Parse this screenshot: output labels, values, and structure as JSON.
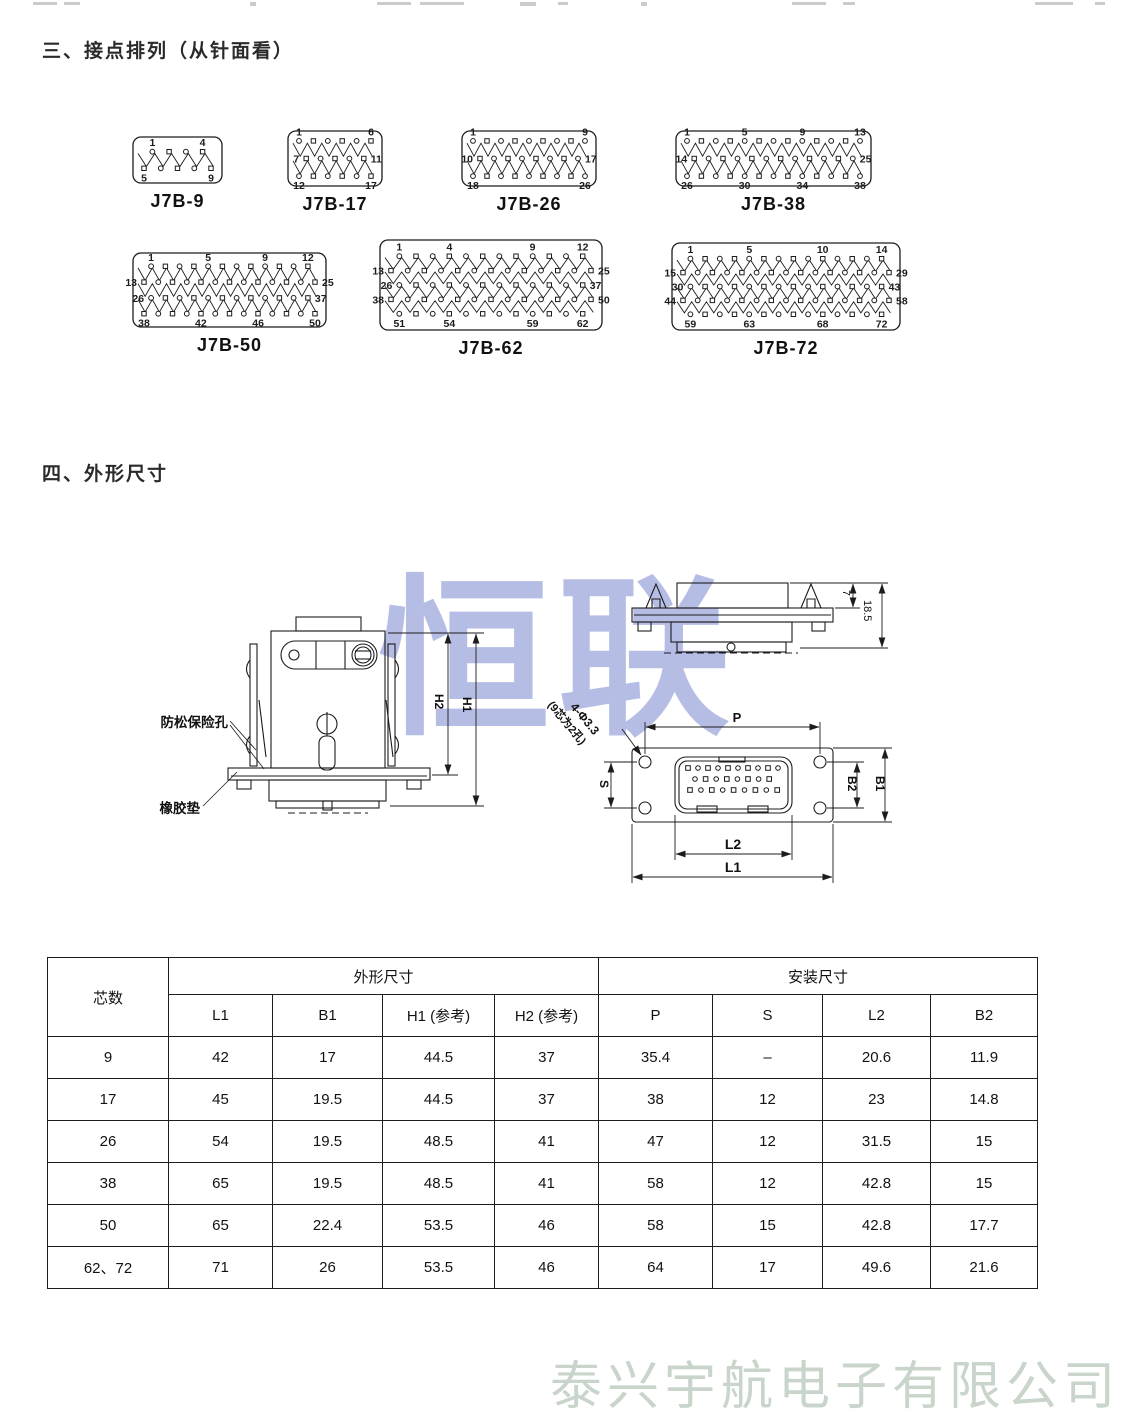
{
  "page": {
    "section3_title": "三、接点排列（从针面看）",
    "section4_title": "四、外形尺寸",
    "center_watermark": "恒联",
    "footer_watermark": "泰兴宇航电子有限公司"
  },
  "connectors": [
    {
      "name": "J7B-9",
      "x": 133,
      "y": 137,
      "w": 89,
      "h": 46,
      "rows": [
        {
          "n": 4,
          "pos": "above",
          "labels": [
            [
              "1",
              0
            ],
            [
              "4",
              1
            ]
          ]
        },
        {
          "n": 5,
          "pos": "below",
          "labels": [
            [
              "5",
              0
            ],
            [
              "9",
              1
            ]
          ]
        }
      ]
    },
    {
      "name": "J7B-17",
      "x": 288,
      "y": 131,
      "w": 94,
      "h": 55,
      "rows": [
        {
          "n": 6,
          "pos": "above",
          "labels": [
            [
              "1",
              0
            ],
            [
              "6",
              1
            ]
          ]
        },
        {
          "n": 5,
          "pos": "side",
          "labels": [
            [
              "7",
              0
            ],
            [
              "11",
              1
            ]
          ]
        },
        {
          "n": 6,
          "pos": "below",
          "labels": [
            [
              "12",
              0
            ],
            [
              "17",
              1
            ]
          ]
        }
      ]
    },
    {
      "name": "J7B-26",
      "x": 462,
      "y": 131,
      "w": 134,
      "h": 55,
      "rows": [
        {
          "n": 9,
          "pos": "above",
          "labels": [
            [
              "1",
              0
            ],
            [
              "9",
              1
            ]
          ]
        },
        {
          "n": 8,
          "pos": "side",
          "labels": [
            [
              "10",
              0
            ],
            [
              "17",
              1
            ]
          ]
        },
        {
          "n": 9,
          "pos": "below",
          "labels": [
            [
              "18",
              0
            ],
            [
              "26",
              1
            ]
          ]
        }
      ]
    },
    {
      "name": "J7B-38",
      "x": 676,
      "y": 131,
      "w": 195,
      "h": 55,
      "rows": [
        {
          "n": 13,
          "pos": "above",
          "labels": [
            [
              "1",
              0
            ],
            [
              "5",
              0.333
            ],
            [
              "9",
              0.667
            ],
            [
              "13",
              1
            ]
          ]
        },
        {
          "n": 12,
          "pos": "side",
          "labels": [
            [
              "14",
              0
            ],
            [
              "25",
              1
            ]
          ]
        },
        {
          "n": 13,
          "pos": "below",
          "labels": [
            [
              "26",
              0
            ],
            [
              "30",
              0.333
            ],
            [
              "34",
              0.667
            ],
            [
              "38",
              1
            ]
          ]
        }
      ]
    },
    {
      "name": "J7B-50",
      "x": 133,
      "y": 253,
      "w": 193,
      "h": 74,
      "rows": [
        {
          "n": 12,
          "pos": "above",
          "labels": [
            [
              "1",
              0
            ],
            [
              "5",
              0.364
            ],
            [
              "9",
              0.727
            ],
            [
              "12",
              1
            ]
          ]
        },
        {
          "n": 13,
          "pos": "side",
          "labels": [
            [
              "13",
              0
            ],
            [
              "25",
              1
            ]
          ]
        },
        {
          "n": 12,
          "pos": "side",
          "labels": [
            [
              "26",
              0
            ],
            [
              "37",
              1
            ]
          ]
        },
        {
          "n": 13,
          "pos": "below",
          "labels": [
            [
              "38",
              0
            ],
            [
              "42",
              0.333
            ],
            [
              "46",
              0.667
            ],
            [
              "50",
              1
            ]
          ]
        }
      ]
    },
    {
      "name": "J7B-62",
      "x": 380,
      "y": 240,
      "w": 222,
      "h": 90,
      "rows": [
        {
          "n": 12,
          "pos": "above",
          "labels": [
            [
              "1",
              0
            ],
            [
              "4",
              0.273
            ],
            [
              "9",
              0.727
            ],
            [
              "12",
              1
            ]
          ]
        },
        {
          "n": 13,
          "pos": "side",
          "labels": [
            [
              "13",
              0
            ],
            [
              "25",
              1
            ]
          ]
        },
        {
          "n": 12,
          "pos": "side",
          "labels": [
            [
              "26",
              0
            ],
            [
              "37",
              1
            ]
          ]
        },
        {
          "n": 13,
          "pos": "side",
          "labels": [
            [
              "38",
              0
            ],
            [
              "50",
              1
            ]
          ]
        },
        {
          "n": 12,
          "pos": "below",
          "labels": [
            [
              "51",
              0
            ],
            [
              "54",
              0.273
            ],
            [
              "59",
              0.727
            ],
            [
              "62",
              1
            ]
          ]
        }
      ]
    },
    {
      "name": "J7B-72",
      "x": 672,
      "y": 243,
      "w": 228,
      "h": 87,
      "rows": [
        {
          "n": 14,
          "pos": "above",
          "labels": [
            [
              "1",
              0
            ],
            [
              "5",
              0.308
            ],
            [
              "10",
              0.692
            ],
            [
              "14",
              1
            ]
          ]
        },
        {
          "n": 15,
          "pos": "side",
          "labels": [
            [
              "15",
              0
            ],
            [
              "29",
              1
            ]
          ]
        },
        {
          "n": 14,
          "pos": "side",
          "labels": [
            [
              "30",
              0
            ],
            [
              "43",
              1
            ]
          ]
        },
        {
          "n": 15,
          "pos": "side",
          "labels": [
            [
              "44",
              0
            ],
            [
              "58",
              1
            ]
          ]
        },
        {
          "n": 14,
          "pos": "below",
          "labels": [
            [
              "59",
              0
            ],
            [
              "63",
              0.308
            ],
            [
              "68",
              0.692
            ],
            [
              "72",
              1
            ]
          ]
        }
      ]
    }
  ],
  "drawing": {
    "front": {
      "lock_hole": "防松保险孔",
      "rubber_pad": "橡胶垫",
      "h1": "H1",
      "h2": "H2"
    },
    "side": {
      "clip_height": "7",
      "height": "18.5"
    },
    "face": {
      "p": "P",
      "s": "S",
      "l2": "L2",
      "l1": "L1",
      "b2": "B2",
      "b1": "B1",
      "note1": "4-Φ3.3",
      "note2": "(9芯为2孔)"
    }
  },
  "table": {
    "col_cores": "芯数",
    "group_outline": "外形尺寸",
    "group_mount": "安装尺寸",
    "headers": [
      "L1",
      "B1",
      "H1 (参考)",
      "H2 (参考)",
      "P",
      "S",
      "L2",
      "B2"
    ],
    "rows": [
      {
        "cells": [
          "9",
          "42",
          "17",
          "44.5",
          "37",
          "35.4",
          "–",
          "20.6",
          "11.9"
        ]
      },
      {
        "cells": [
          "17",
          "45",
          "19.5",
          "44.5",
          "37",
          "38",
          "12",
          "23",
          "14.8"
        ]
      },
      {
        "cells": [
          "26",
          "54",
          "19.5",
          "48.5",
          "41",
          "47",
          "12",
          "31.5",
          "15"
        ]
      },
      {
        "cells": [
          "38",
          "65",
          "19.5",
          "48.5",
          "41",
          "58",
          "12",
          "42.8",
          "15"
        ]
      },
      {
        "cells": [
          "50",
          "65",
          "22.4",
          "53.5",
          "46",
          "58",
          "15",
          "42.8",
          "17.7"
        ]
      },
      {
        "cells": [
          "62、72",
          "71",
          "26",
          "53.5",
          "46",
          "64",
          "17",
          "49.6",
          "21.6"
        ]
      }
    ]
  },
  "colors": {
    "line": "#1c1c1c",
    "watermark_blue": "#b6bde5",
    "watermark_gray": "#c9d4cb"
  }
}
